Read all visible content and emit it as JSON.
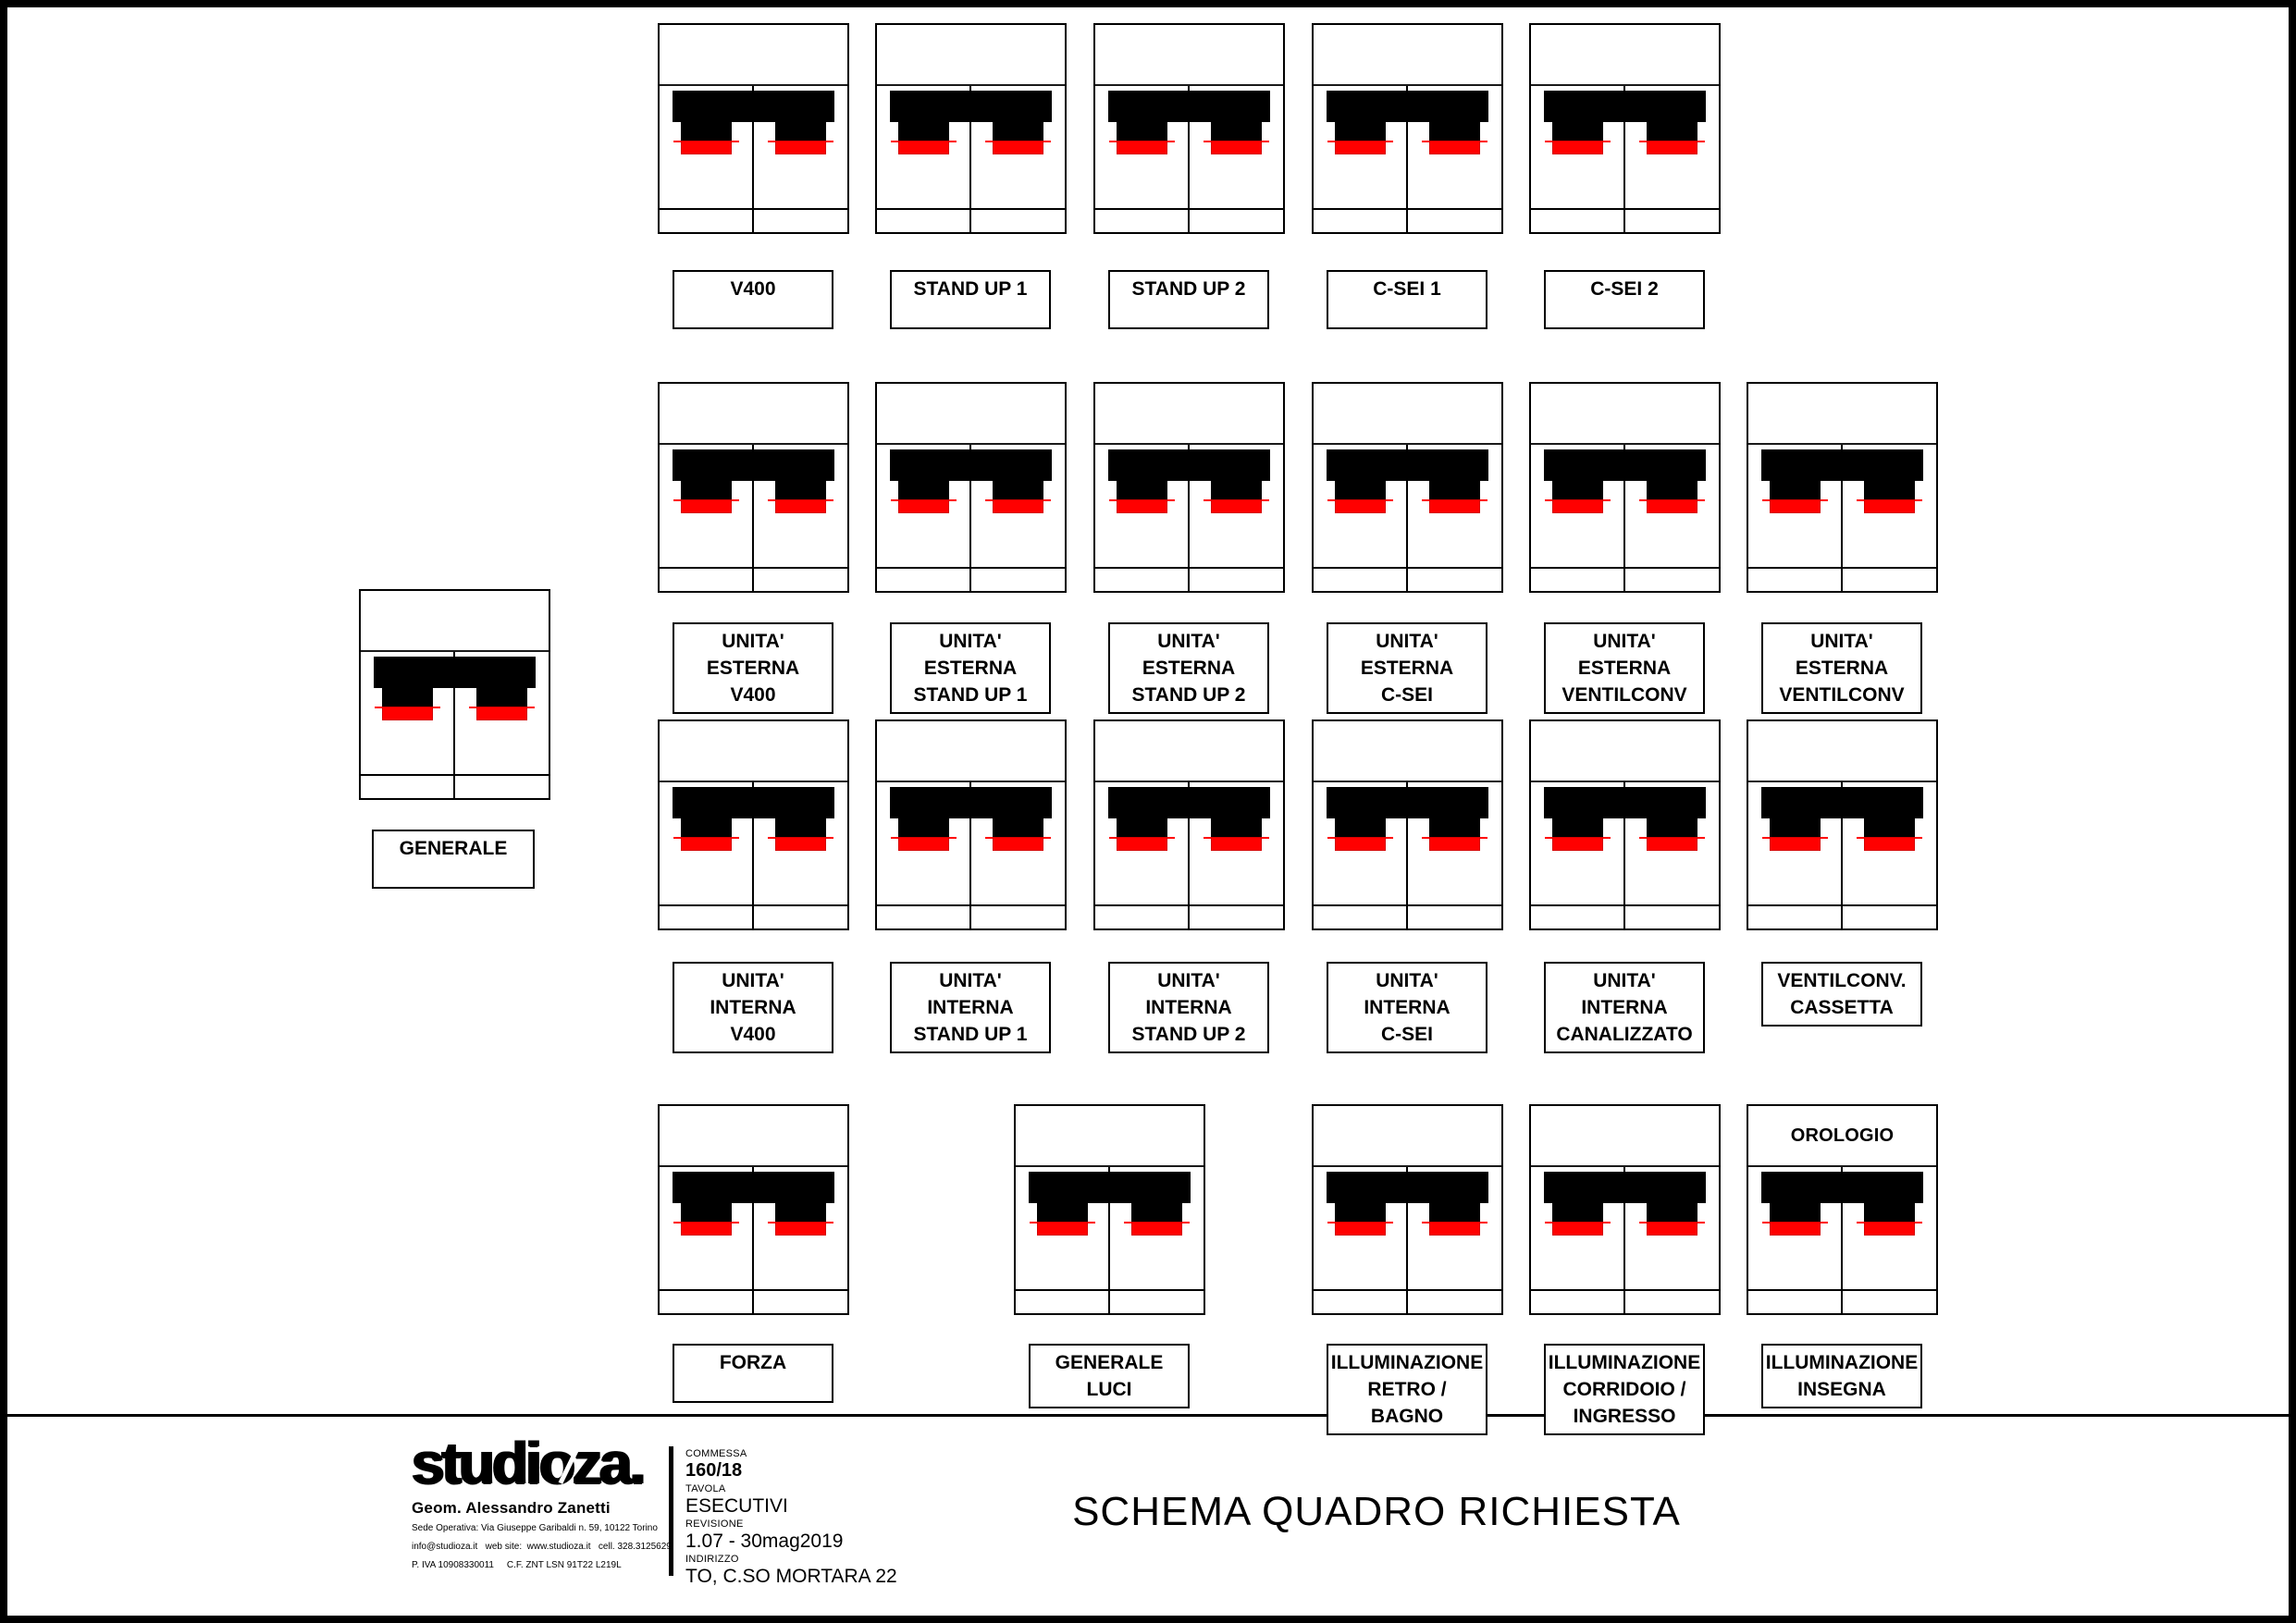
{
  "sheet_title": "SCHEMA QUADRO RICHIESTA",
  "studio": {
    "brand": "studioza.",
    "owner": "Geom. Alessandro Zanetti",
    "address": "Sede Operativa: Via Giuseppe Garibaldi n. 59, 10122 Torino",
    "contacts": "info@studioza.it   web site:  www.studioza.it   cell. 328.3125629",
    "fiscal": "P. IVA 10908330011     C.F. ZNT LSN 91T22 L219L"
  },
  "fields": [
    {
      "label": "COMMESSA",
      "value": "160/18"
    },
    {
      "label": "TAVOLA",
      "value": "ESECUTIVI"
    },
    {
      "label": "REVISIONE",
      "value": "1.07 - 30mag2019"
    },
    {
      "label": "INDIRIZZO",
      "value": "TO, C.SO MORTARA 22"
    }
  ],
  "colors": {
    "line": "#000000",
    "breaker_body": "#000000",
    "pole_tip_red": "#ff0000",
    "pole_tip_edge": "#d40000",
    "background": "#ffffff"
  },
  "diagram": {
    "main_breaker": {
      "label_lines": [
        "GENERALE"
      ]
    },
    "rows": [
      {
        "modules": [
          {
            "label_lines": [
              "V400"
            ]
          },
          {
            "label_lines": [
              "STAND UP 1"
            ]
          },
          {
            "label_lines": [
              "STAND UP 2"
            ]
          },
          {
            "label_lines": [
              "C-SEI 1"
            ]
          },
          {
            "label_lines": [
              "C-SEI 2"
            ]
          }
        ]
      },
      {
        "modules": [
          {
            "label_lines": [
              "UNITA' ESTERNA",
              "V400"
            ]
          },
          {
            "label_lines": [
              "UNITA' ESTERNA",
              "STAND UP 1"
            ]
          },
          {
            "label_lines": [
              "UNITA' ESTERNA",
              "STAND UP 2"
            ]
          },
          {
            "label_lines": [
              "UNITA' ESTERNA",
              "C-SEI"
            ]
          },
          {
            "label_lines": [
              "UNITA' ESTERNA",
              "VENTILCONV"
            ]
          },
          {
            "label_lines": [
              "UNITA' ESTERNA",
              "VENTILCONV"
            ]
          }
        ]
      },
      {
        "modules": [
          {
            "label_lines": [
              "UNITA' INTERNA",
              "V400"
            ]
          },
          {
            "label_lines": [
              "UNITA' INTERNA",
              "STAND UP 1"
            ]
          },
          {
            "label_lines": [
              "UNITA' INTERNA",
              "STAND UP 2"
            ]
          },
          {
            "label_lines": [
              "UNITA' INTERNA",
              "C-SEI"
            ]
          },
          {
            "label_lines": [
              "UNITA' INTERNA",
              "CANALIZZATO"
            ]
          },
          {
            "label_lines": [
              "VENTILCONV.",
              "CASSETTA"
            ]
          }
        ]
      },
      {
        "modules": [
          {
            "label_lines": [
              "FORZA"
            ]
          },
          {
            "label_lines": [
              "GENERALE",
              "LUCI"
            ]
          },
          {
            "label_lines": [
              "ILLUMINAZIONE",
              "RETRO / BAGNO"
            ]
          },
          {
            "label_lines": [
              "ILLUMINAZIONE",
              "CORRIDOIO /",
              "INGRESSO"
            ]
          },
          {
            "top_text": "OROLOGIO",
            "label_lines": [
              "ILLUMINAZIONE",
              "INSEGNA"
            ]
          }
        ]
      }
    ]
  }
}
